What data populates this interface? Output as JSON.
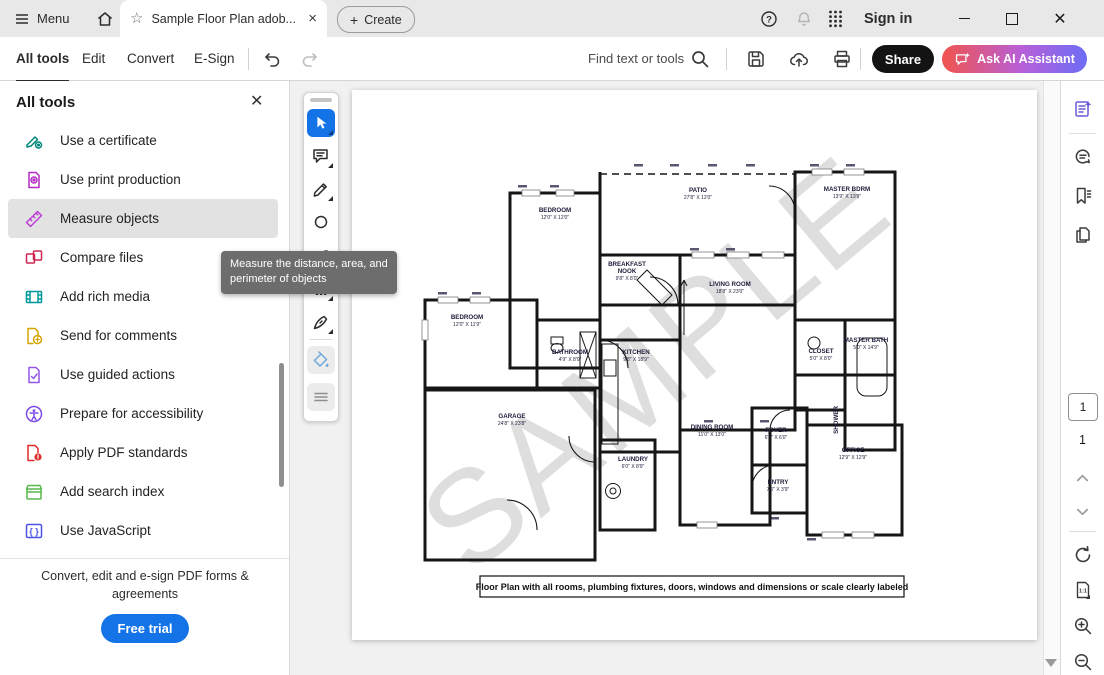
{
  "titlebar": {
    "menu_label": "Menu",
    "tab_title": "Sample Floor Plan adob...",
    "create_label": "Create",
    "sign_in_label": "Sign in"
  },
  "toolbar": {
    "nav": [
      "All tools",
      "Edit",
      "Convert",
      "E-Sign"
    ],
    "find_label": "Find text or tools",
    "share_label": "Share",
    "ask_ai_label": "Ask AI Assistant"
  },
  "tools_panel": {
    "header": "All tools",
    "items": [
      {
        "label": "Use a certificate",
        "icon": "certificate",
        "color": "#00857a"
      },
      {
        "label": "Use print production",
        "icon": "print-production",
        "color": "#b32bc4"
      },
      {
        "label": "Measure objects",
        "icon": "measure-ruler",
        "color": "#bc3fd6",
        "active": true
      },
      {
        "label": "Compare files",
        "icon": "compare-files",
        "color": "#d02752"
      },
      {
        "label": "Add rich media",
        "icon": "rich-media",
        "color": "#00999e"
      },
      {
        "label": "Send for comments",
        "icon": "send-comments",
        "color": "#d7a300"
      },
      {
        "label": "Use guided actions",
        "icon": "guided-actions",
        "color": "#9356e8"
      },
      {
        "label": "Prepare for accessibility",
        "icon": "accessibility",
        "color": "#7d4ce8"
      },
      {
        "label": "Apply PDF standards",
        "icon": "pdf-standards",
        "color": "#e02b2b"
      },
      {
        "label": "Add search index",
        "icon": "search-index",
        "color": "#58b84e"
      },
      {
        "label": "Use JavaScript",
        "icon": "javascript",
        "color": "#4a52e8"
      }
    ],
    "footer": "Convert, edit and e-sign PDF forms & agreements",
    "cta_label": "Free trial"
  },
  "tooltip_text": "Measure the distance, area, and perimeter of objects",
  "quick_tools": [
    {
      "icon": "select-cursor",
      "active": true,
      "caret": true,
      "top": 16
    },
    {
      "icon": "add-comment",
      "caret": true,
      "top": 49
    },
    {
      "icon": "draw-pencil",
      "caret": true,
      "top": 82
    },
    {
      "icon": "highlight",
      "caret": false,
      "top": 115
    },
    {
      "icon": "shapes",
      "caret": true,
      "top": 148
    },
    {
      "icon": "add-text",
      "caret": true,
      "top": 182
    },
    {
      "icon": "fill-sign-pen",
      "caret": true,
      "top": 215
    },
    {
      "icon": "fill-color-bucket",
      "muted": true,
      "tint": "#6fa8dc",
      "top": 253
    },
    {
      "icon": "more-lines",
      "muted": true,
      "tint": "#8e8e8e",
      "top": 290
    }
  ],
  "right_rail": {
    "icons": [
      {
        "icon": "ai-assistant",
        "color": "#6a5bd8",
        "top": 18
      },
      {
        "icon": "comments",
        "top": 66
      },
      {
        "icon": "bookmarks",
        "top": 105
      },
      {
        "icon": "page-copies",
        "top": 144
      }
    ],
    "current_page": "1",
    "total_pages": "1"
  },
  "document": {
    "watermark": "SAMPLE",
    "caption": "Floor Plan with all rooms, plumbing fixtures, doors, windows and dimensions or scale clearly labeled",
    "rooms": [
      {
        "name": "BEDROOM",
        "dim": "12'0\" X 12'0\"",
        "x": 203,
        "y": 122
      },
      {
        "name": "PATIO",
        "dim": "27'8\" X 12'0\"",
        "x": 346,
        "y": 102
      },
      {
        "name": "MASTER BDRM",
        "dim": "13'9\" X 13'9\"",
        "x": 495,
        "y": 101
      },
      {
        "name": "BREAKFAST",
        "name2": "NOOK",
        "dim": "9'8\" X 8'0\"",
        "x": 275,
        "y": 176
      },
      {
        "name": "LIVING ROOM",
        "dim": "18'8\" X 23'0\"",
        "x": 378,
        "y": 196
      },
      {
        "name": "BEDROOM",
        "dim": "12'0\" X 11'9\"",
        "x": 115,
        "y": 229
      },
      {
        "name": "BATHROOM",
        "dim": "4'9\" X 8'0\"",
        "x": 218,
        "y": 264
      },
      {
        "name": "KITCHEN",
        "dim": "9'8\" X 18'9\"",
        "x": 284,
        "y": 264
      },
      {
        "name": "CLOSET",
        "dim": "5'0\" X 8'0\"",
        "x": 469,
        "y": 263
      },
      {
        "name": "MASTER BATH",
        "dim": "5'0\" X 14'9\"",
        "x": 514,
        "y": 252
      },
      {
        "name": "GARAGE",
        "dim": "24'8\" X 23'8\"",
        "x": 160,
        "y": 328
      },
      {
        "name": "LAUNDRY",
        "dim": "6'0\" X 8'9\"",
        "x": 281,
        "y": 371
      },
      {
        "name": "DINING ROOM",
        "dim": "11'0\" X 13'0\"",
        "x": 360,
        "y": 339
      },
      {
        "name": "FOYER",
        "dim": "6'0\" X 6'0\"",
        "x": 424,
        "y": 342
      },
      {
        "name": "ENTRY",
        "dim": "7'6\" X 3'9\"",
        "x": 426,
        "y": 394
      },
      {
        "name": "OFFICE",
        "dim": "12'9\" X 12'9\"",
        "x": 501,
        "y": 362
      },
      {
        "name": "SHOWER",
        "dim": "",
        "x": 486,
        "y": 330,
        "vertical": true
      }
    ]
  }
}
